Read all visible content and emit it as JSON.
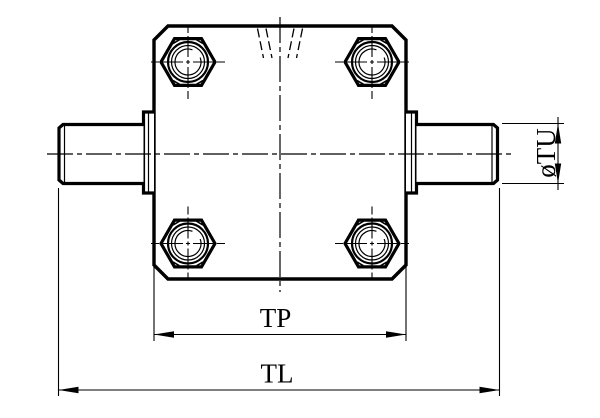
{
  "drawing": {
    "background_color": "#ffffff",
    "line_color": "#000000",
    "labels": {
      "tp": "TP",
      "tl": "TL",
      "tu": "øTU"
    }
  }
}
